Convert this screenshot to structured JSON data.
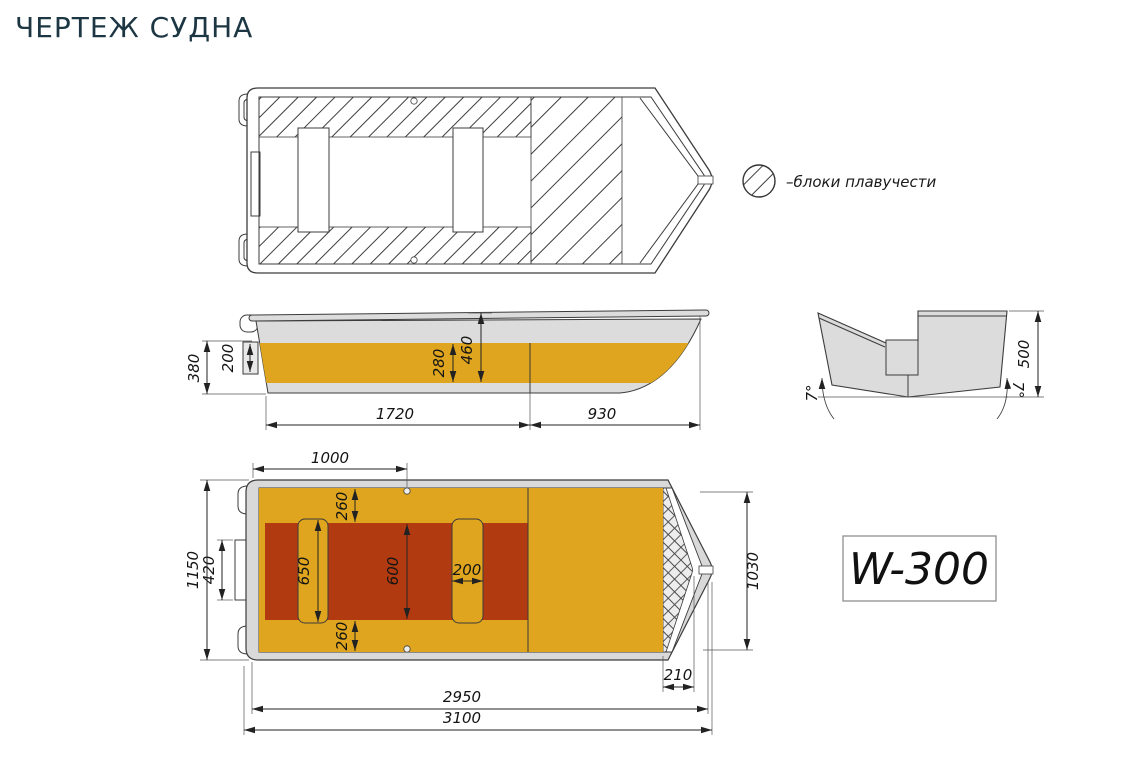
{
  "page": {
    "title": "ЧЕРТЕЖ СУДНА"
  },
  "legend": {
    "label": "–блоки плавучести",
    "swatch": "hatched-circle"
  },
  "badge": {
    "model": "W-300"
  },
  "colors": {
    "accent_yellow": "#DFA51E",
    "accent_red": "#B23A10",
    "hull_gray": "#DCDCDC",
    "line": "#3C3C3C",
    "title_color": "#1D3643"
  },
  "side_view": {
    "dims": {
      "transom_height": "380",
      "motor_plate": "200",
      "band_height": "280",
      "inner_depth": "460",
      "cockpit_length": "1720",
      "bow_length": "930"
    }
  },
  "rear_view": {
    "dims": {
      "height": "500",
      "deadrise_left": "7°",
      "deadrise_right": "7°"
    }
  },
  "bottom_view": {
    "dims": {
      "stern_to_hook": "1000",
      "band_top": "260",
      "motor_plate_width": "420",
      "bench_length": "650",
      "floor_width": "600",
      "bench_width": "200",
      "band_bottom": "260",
      "beam_overall": "1150",
      "beam_inner": "1030",
      "bow_block": "210",
      "inner_length": "2950",
      "overall_length": "3100"
    }
  }
}
